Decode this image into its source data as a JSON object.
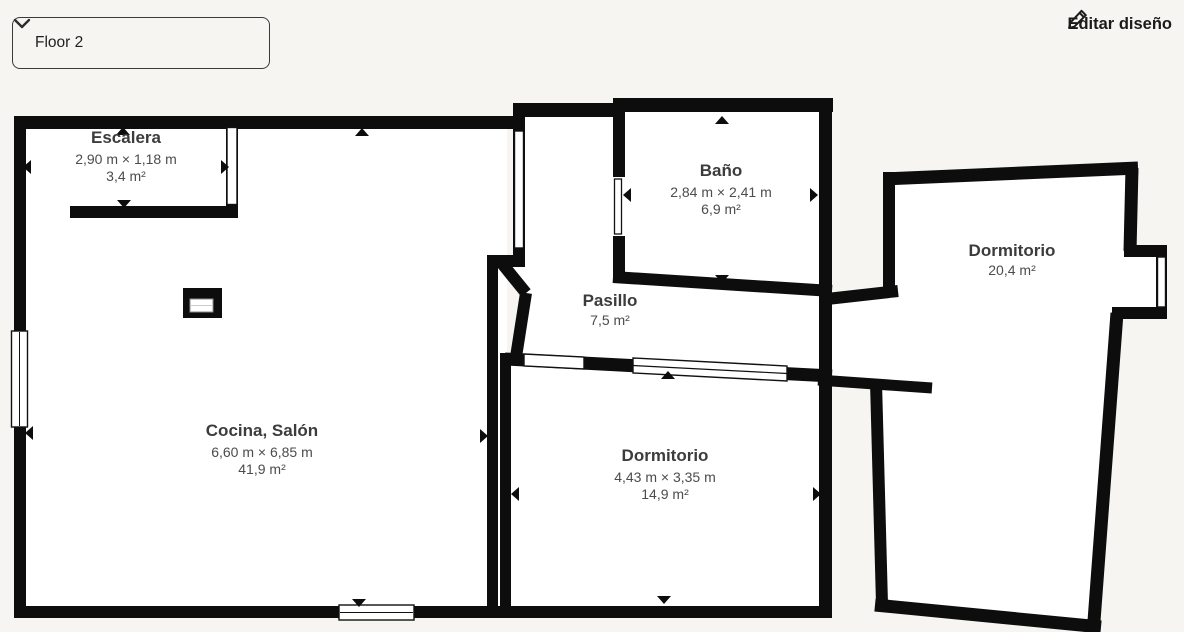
{
  "header": {
    "floor_selector": {
      "value": "Floor 2"
    },
    "edit_button": {
      "label": "Editar diseño"
    }
  },
  "floorplan": {
    "rooms": [
      {
        "id": "escalera",
        "name": "Escalera",
        "dimensions": "2,90 m × 1,18 m",
        "area": "3,4 m²"
      },
      {
        "id": "bano",
        "name": "Baño",
        "dimensions": "2,84 m × 2,41 m",
        "area": "6,9 m²"
      },
      {
        "id": "pasillo",
        "name": "Pasillo",
        "area": "7,5 m²"
      },
      {
        "id": "dormitorio-grande",
        "name": "Dormitorio",
        "area": "20,4 m²"
      },
      {
        "id": "cocina-salon",
        "name": "Cocina, Salón",
        "dimensions": "6,60 m × 6,85 m",
        "area": "41,9 m²"
      },
      {
        "id": "dormitorio",
        "name": "Dormitorio",
        "dimensions": "4,43 m × 3,35 m",
        "area": "14,9 m²"
      }
    ]
  },
  "colors": {
    "background": "#f6f5f2",
    "wall": "#0d0d0d",
    "room_fill": "#ffffff",
    "label_text": "#3c3c3c",
    "header_text": "#1b1b1b"
  }
}
